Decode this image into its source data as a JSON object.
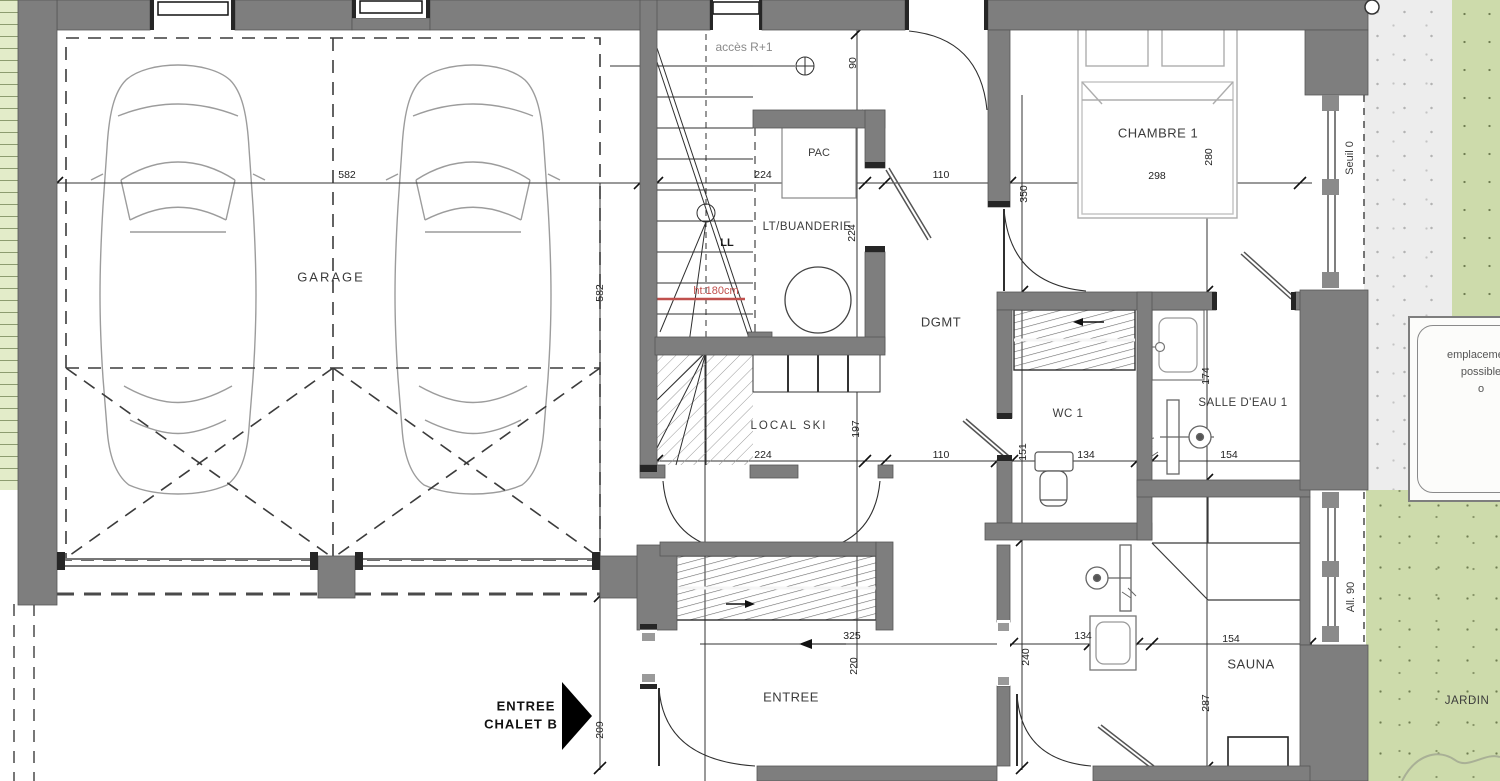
{
  "document": {
    "type": "architectural floor plan",
    "building": "CHALET B",
    "units": "cm"
  },
  "colors": {
    "wall": "#7e7e7e",
    "jamb": "#262626",
    "grass": "#cddbab",
    "terrace": "#ededed",
    "ruler_strip": "#e3ecc9",
    "annotation_red": "#c0504d",
    "line": "#2f2f2f"
  },
  "labels": [
    {
      "name": "room-label-garage",
      "text": "GARAGE",
      "x": 331,
      "y": 277,
      "cls": "room sp"
    },
    {
      "name": "room-label-chambre-1",
      "text": "CHAMBRE 1",
      "x": 1158,
      "y": 133,
      "cls": "room"
    },
    {
      "name": "room-label-lt-buanderie",
      "text": "LT/BUANDERIE",
      "x": 807,
      "y": 227,
      "cls": "room sm"
    },
    {
      "name": "room-label-local-ski",
      "text": "LOCAL SKI",
      "x": 789,
      "y": 426,
      "cls": "room sm sp"
    },
    {
      "name": "room-label-dgmt",
      "text": "DGMT",
      "x": 941,
      "y": 322,
      "cls": "room"
    },
    {
      "name": "room-label-wc-1",
      "text": "WC 1",
      "x": 1068,
      "y": 414,
      "cls": "room sm"
    },
    {
      "name": "room-label-salle-deau-1",
      "text": "SALLE D'EAU 1",
      "x": 1243,
      "y": 403,
      "cls": "room sm"
    },
    {
      "name": "room-label-entree",
      "text": "ENTREE",
      "x": 791,
      "y": 697,
      "cls": "room"
    },
    {
      "name": "room-label-sauna",
      "text": "SAUNA",
      "x": 1251,
      "y": 664,
      "cls": "room"
    },
    {
      "name": "room-label-jardin",
      "text": "JARDIN",
      "x": 1467,
      "y": 701,
      "cls": "room sm"
    },
    {
      "name": "equipment-label-pac",
      "text": "PAC",
      "x": 819,
      "y": 153,
      "cls": "small"
    },
    {
      "name": "equipment-label-ll",
      "text": "LL",
      "x": 727,
      "y": 243,
      "cls": "small bold"
    },
    {
      "name": "annotation-acces-r1",
      "text": "accès R+1",
      "x": 744,
      "y": 47,
      "cls": "muted"
    },
    {
      "name": "annotation-ht-180cm",
      "text": "ht:180cm",
      "x": 716,
      "y": 291,
      "cls": "red"
    },
    {
      "name": "annotation-seuil-0",
      "text": "Seuil 0",
      "x": 1350,
      "y": 158,
      "rot": 1,
      "cls": "small"
    },
    {
      "name": "annotation-all-90",
      "text": "All. 90",
      "x": 1351,
      "y": 597,
      "rot": 1,
      "cls": "small"
    },
    {
      "name": "entry-arrow-label-line1",
      "text": "ENTREE",
      "x": 526,
      "y": 706,
      "cls": "entry"
    },
    {
      "name": "entry-arrow-label-line2",
      "text": "CHALET B",
      "x": 521,
      "y": 724,
      "cls": "entry"
    },
    {
      "name": "note-line-1",
      "text": "emplacement",
      "x": 1480,
      "y": 355,
      "cls": "note"
    },
    {
      "name": "note-line-2",
      "text": "possible",
      "x": 1481,
      "y": 372,
      "cls": "note"
    },
    {
      "name": "note-line-3",
      "text": "o",
      "x": 1481,
      "y": 389,
      "cls": "note"
    }
  ],
  "dimensions_cm": [
    {
      "name": "dim-garage-width",
      "text": "582",
      "x": 347,
      "y": 175
    },
    {
      "name": "dim-stairwell-width",
      "text": "224",
      "x": 763,
      "y": 175
    },
    {
      "name": "dim-hall-width-top",
      "text": "110",
      "x": 941,
      "y": 175
    },
    {
      "name": "dim-chambre-width",
      "text": "298",
      "x": 1157,
      "y": 176
    },
    {
      "name": "dim-door-top",
      "text": "90",
      "x": 853,
      "y": 63,
      "rot": 1
    },
    {
      "name": "dim-chambre-depth",
      "text": "280",
      "x": 1209,
      "y": 157,
      "rot": 1
    },
    {
      "name": "dim-chambre-height",
      "text": "350",
      "x": 1024,
      "y": 194,
      "rot": 1
    },
    {
      "name": "dim-garage-depth",
      "text": "582",
      "x": 600,
      "y": 293,
      "rot": 1
    },
    {
      "name": "dim-buanderie-depth",
      "text": "224",
      "x": 852,
      "y": 233,
      "rot": 1
    },
    {
      "name": "dim-local-ski-width",
      "text": "224",
      "x": 763,
      "y": 455
    },
    {
      "name": "dim-hall-width-mid",
      "text": "110",
      "x": 941,
      "y": 455
    },
    {
      "name": "dim-wc-width",
      "text": "134",
      "x": 1086,
      "y": 455
    },
    {
      "name": "dim-salle-deau-width",
      "text": "154",
      "x": 1229,
      "y": 455
    },
    {
      "name": "dim-local-ski-depth",
      "text": "197",
      "x": 856,
      "y": 429,
      "rot": 1
    },
    {
      "name": "dim-wc-depth",
      "text": "151",
      "x": 1023,
      "y": 452,
      "rot": 1
    },
    {
      "name": "dim-salle-deau-depth",
      "text": "174",
      "x": 1206,
      "y": 376,
      "rot": 1
    },
    {
      "name": "dim-entree-width",
      "text": "325",
      "x": 852,
      "y": 636
    },
    {
      "name": "dim-entree-depth",
      "text": "220",
      "x": 854,
      "y": 666,
      "rot": 1
    },
    {
      "name": "dim-shower-room-width",
      "text": "134",
      "x": 1083,
      "y": 636
    },
    {
      "name": "dim-sauna-width",
      "text": "154",
      "x": 1231,
      "y": 639
    },
    {
      "name": "dim-shower-room-depth",
      "text": "240",
      "x": 1026,
      "y": 657,
      "rot": 1
    },
    {
      "name": "dim-sauna-depth",
      "text": "287",
      "x": 1206,
      "y": 703,
      "rot": 1
    },
    {
      "name": "dim-entry-side",
      "text": "209",
      "x": 600,
      "y": 730,
      "rot": 1
    }
  ]
}
